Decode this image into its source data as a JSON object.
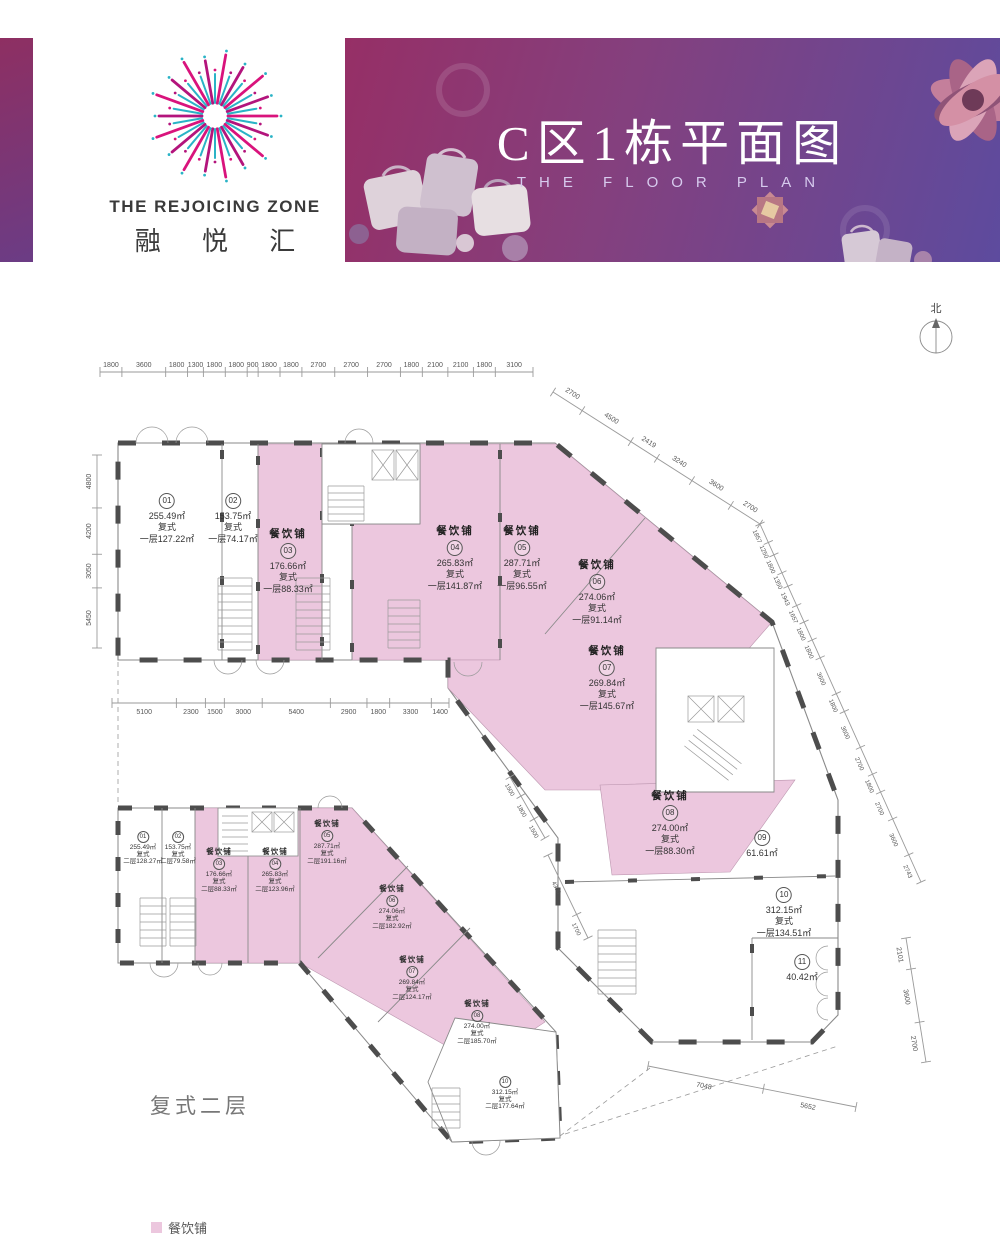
{
  "brand": {
    "name_en": "THE REJOICING ZONE",
    "name_zh": "融 悦 汇"
  },
  "banner": {
    "title": "C区1栋平面图",
    "subtitle": "THE FLOOR PLAN"
  },
  "compass": {
    "label": "北"
  },
  "section_label": "复式二层",
  "legend": {
    "label": "餐饮铺"
  },
  "colors": {
    "dining": "#ecc7de",
    "wall": "#4d4d4d",
    "logo_pink": "#d9137c",
    "logo_pink2": "#b3147c",
    "logo_teal": "#2ab3c6"
  },
  "floor1_units": [
    {
      "no": "01",
      "area": "255.49㎡",
      "type": "复式",
      "floor": "一层127.22㎡"
    },
    {
      "no": "02",
      "area": "153.75㎡",
      "type": "复式",
      "floor": "一层74.17㎡"
    },
    {
      "name": "餐饮铺",
      "no": "03",
      "area": "176.66㎡",
      "type": "复式",
      "floor": "一层88.33㎡"
    },
    {
      "name": "餐饮铺",
      "no": "04",
      "area": "265.83㎡",
      "type": "复式",
      "floor": "一层141.87㎡"
    },
    {
      "name": "餐饮铺",
      "no": "05",
      "area": "287.71㎡",
      "type": "复式",
      "floor": "一层96.55㎡"
    },
    {
      "name": "餐饮铺",
      "no": "06",
      "area": "274.06㎡",
      "type": "复式",
      "floor": "一层91.14㎡"
    },
    {
      "name": "餐饮铺",
      "no": "07",
      "area": "269.84㎡",
      "type": "复式",
      "floor": "一层145.67㎡"
    },
    {
      "name": "餐饮铺",
      "no": "08",
      "area": "274.00㎡",
      "type": "复式",
      "floor": "一层88.30㎡"
    },
    {
      "no": "09",
      "area": "61.61㎡"
    },
    {
      "no": "10",
      "area": "312.15㎡",
      "type": "复式",
      "floor": "一层134.51㎡"
    },
    {
      "no": "11",
      "area": "40.42㎡"
    }
  ],
  "floor2_units": [
    {
      "no": "01",
      "area": "255.49㎡",
      "type": "复式",
      "floor": "二层128.27㎡"
    },
    {
      "no": "02",
      "area": "153.75㎡",
      "type": "复式",
      "floor": "二层79.58㎡"
    },
    {
      "name": "餐饮铺",
      "no": "03",
      "area": "176.66㎡",
      "type": "复式",
      "floor": "二层88.33㎡"
    },
    {
      "name": "餐饮铺",
      "no": "04",
      "area": "265.83㎡",
      "type": "复式",
      "floor": "二层123.96㎡"
    },
    {
      "name": "餐饮铺",
      "no": "05",
      "area": "287.71㎡",
      "type": "复式",
      "floor": "二层191.16㎡"
    },
    {
      "name": "餐饮铺",
      "no": "06",
      "area": "274.06㎡",
      "type": "复式",
      "floor": "二层182.92㎡"
    },
    {
      "name": "餐饮铺",
      "no": "07",
      "area": "269.84㎡",
      "type": "复式",
      "floor": "二层124.17㎡"
    },
    {
      "name": "餐饮铺",
      "no": "08",
      "area": "274.00㎡",
      "type": "复式",
      "floor": "二层185.70㎡"
    },
    {
      "no": "10",
      "area": "312.15㎡",
      "type": "复式",
      "floor": "二层177.64㎡"
    }
  ],
  "dims": {
    "top": [
      "1800",
      "3600",
      "1800",
      "1300",
      "1800",
      "1800",
      "900",
      "1800",
      "1800",
      "2700",
      "2700",
      "2700",
      "1800",
      "2100",
      "2100",
      "1800",
      "3100"
    ],
    "left": [
      "5450",
      "3050",
      "4200",
      "4800"
    ],
    "mid": [
      "5100",
      "2300",
      "1500",
      "3000",
      "5400",
      "2900",
      "1800",
      "3300",
      "1400"
    ],
    "diag1": [
      "2700",
      "4500",
      "2419",
      "3240",
      "3600",
      "2700"
    ],
    "diag2": [
      "1857",
      "1250",
      "1800",
      "1350",
      "1943",
      "1657",
      "1800",
      "1800",
      "3600",
      "1800",
      "3600",
      "2700",
      "1800",
      "2700",
      "3600",
      "2743"
    ],
    "right": [
      "2101",
      "3600",
      "2700"
    ],
    "bottom": [
      "7048",
      "5652"
    ],
    "inner1": [
      "1500",
      "1800",
      "1500"
    ],
    "inner2": [
      "4300",
      "1700"
    ]
  }
}
